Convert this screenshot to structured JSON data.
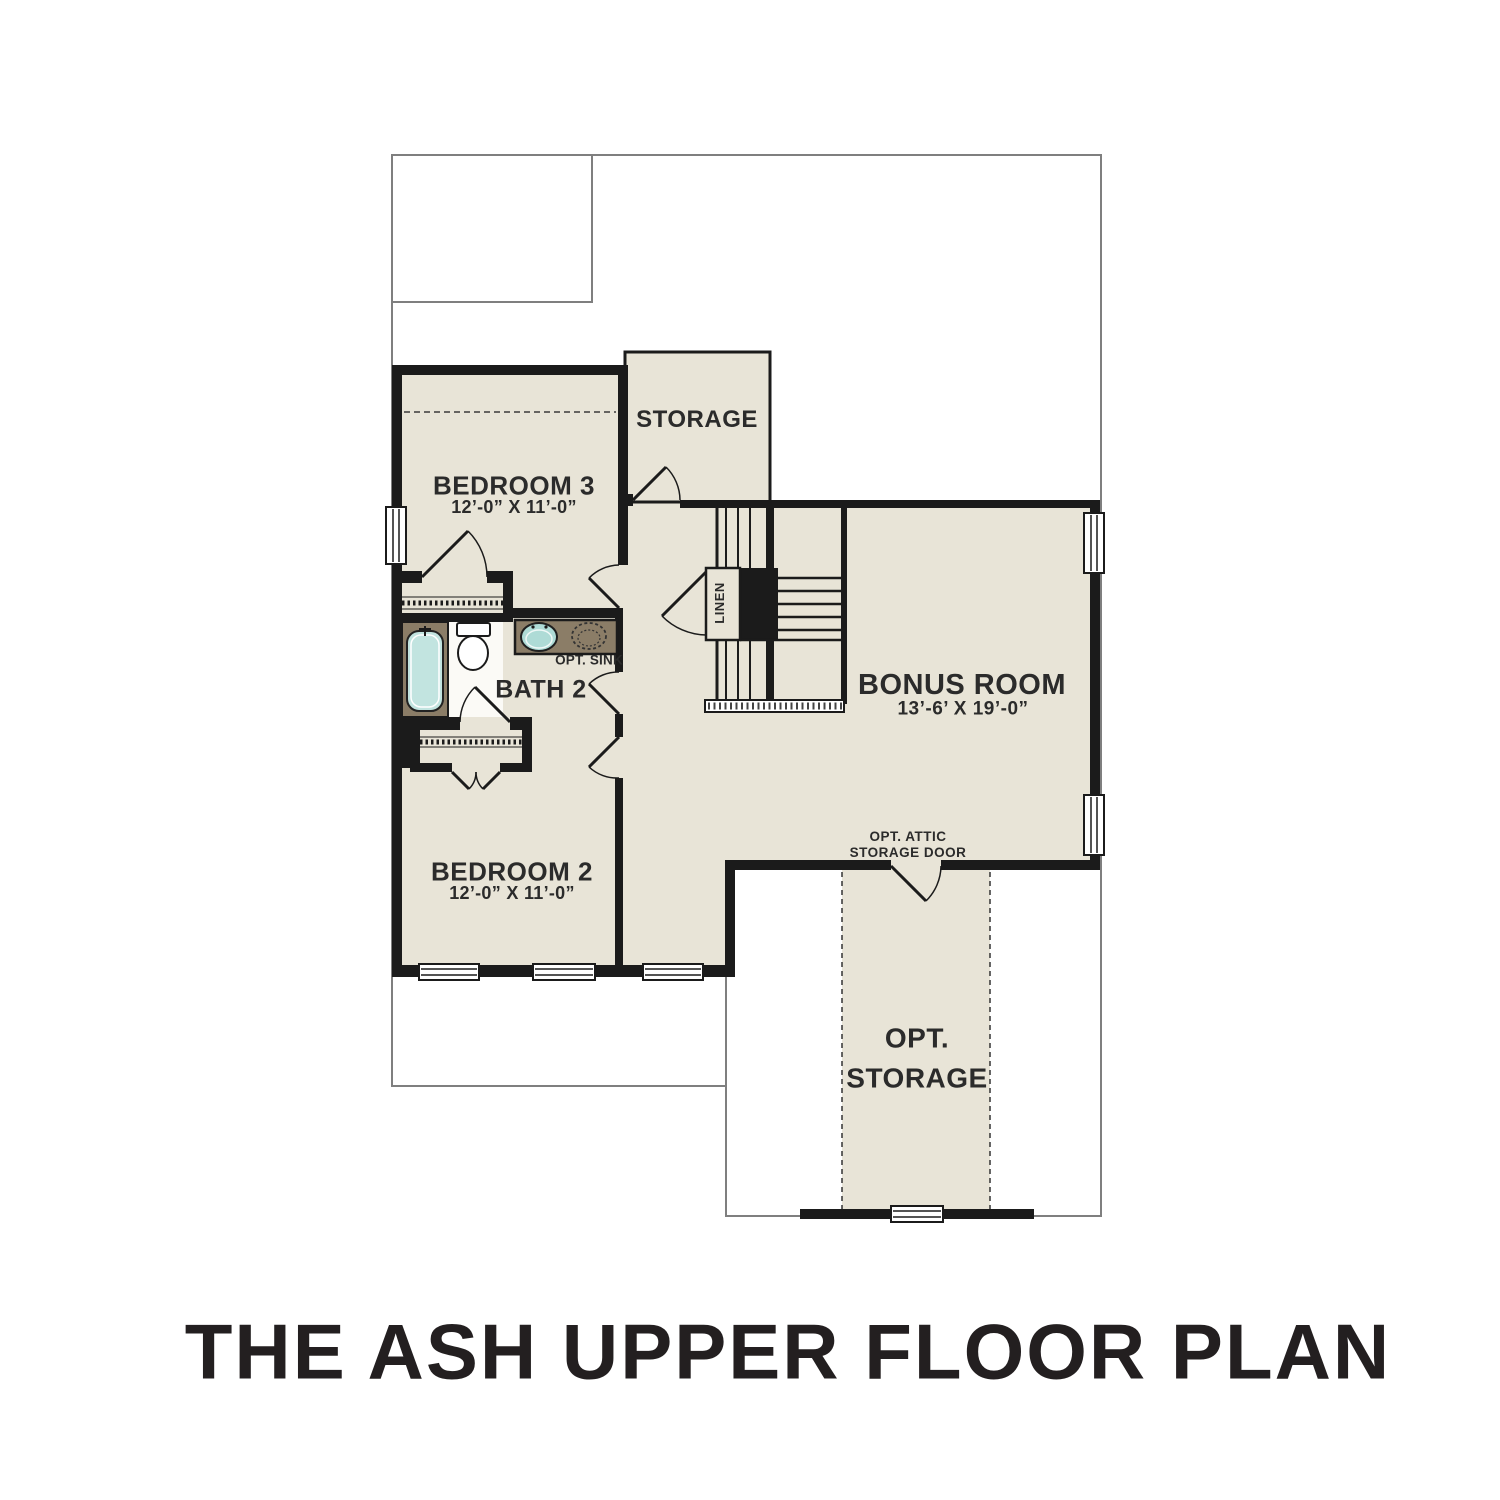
{
  "title": "THE ASH UPPER FLOOR PLAN",
  "rooms": {
    "bedroom3": {
      "label": "BEDROOM 3",
      "dims": "12’-0” X 11’-0”"
    },
    "bedroom2": {
      "label": "BEDROOM 2",
      "dims": "12’-0” X 11’-0”"
    },
    "bonus_room": {
      "label": "BONUS ROOM",
      "dims": "13’-6’ X 19’-0”"
    },
    "bath2": {
      "label": "BATH 2"
    },
    "storage": {
      "label": "STORAGE"
    },
    "opt_storage": {
      "line1": "OPT.",
      "line2": "STORAGE"
    }
  },
  "annotations": {
    "opt_sink": "OPT. SINK",
    "linen": "LINEN",
    "attic_door_line1": "OPT. ATTIC",
    "attic_door_line2": "STORAGE DOOR"
  },
  "colors": {
    "floor": "#e8e4d7",
    "wall": "#1b1b1b",
    "lot_line": "#7f7f7f",
    "counter": "#8b7d67",
    "tub_fill": "#c2e4e0",
    "sink_fill": "#aedbd6",
    "label_text": "#2b2b2b",
    "title_text": "#231f20"
  }
}
